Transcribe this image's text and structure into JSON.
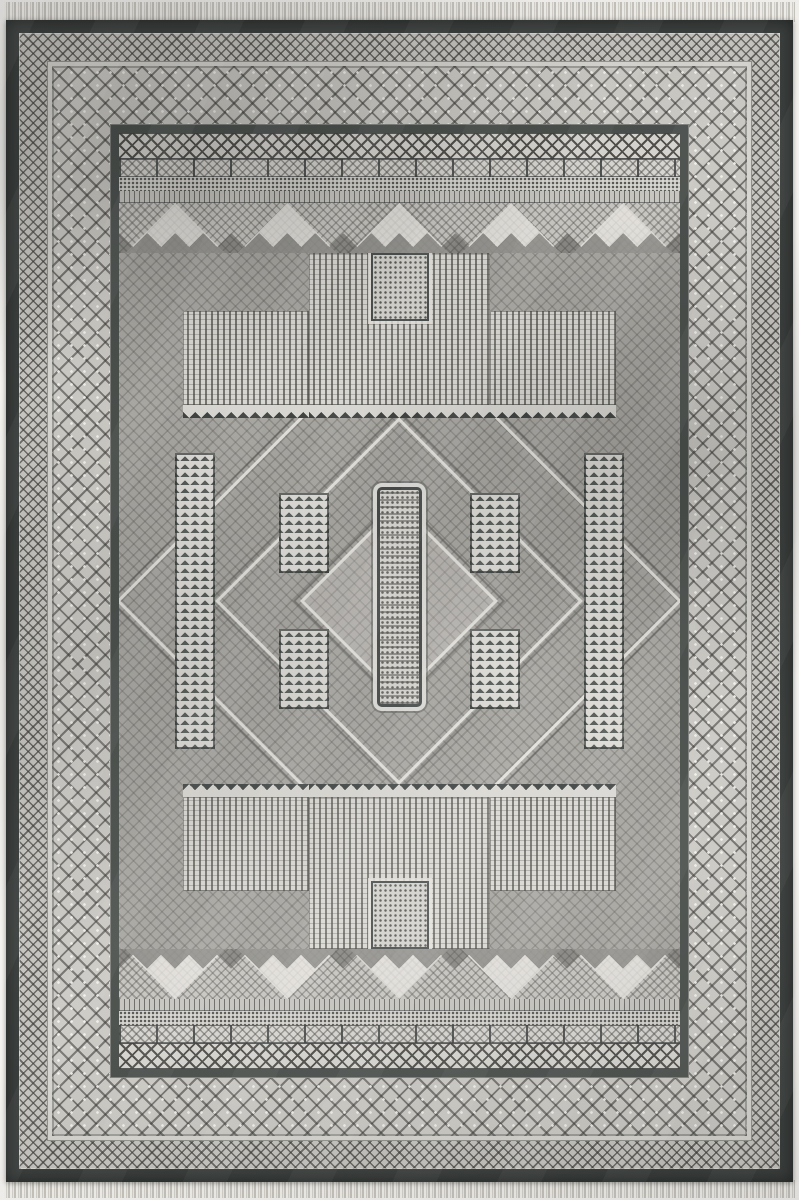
{
  "image": {
    "type": "photograph",
    "subject": "Gray traditional geometric area rug, portrait orientation, with white knotted fringe along the top and bottom edges",
    "style": "monochrome gray tribal/geometric pattern with nested borders and a symmetric central medallion composition"
  },
  "palette": {
    "bg": "#f6f4f1",
    "fringe": "#efede8",
    "frame": "#3c403e",
    "guard": "#4a4f4c",
    "band-light": "#c6c4bf",
    "pat-light": "#d6d4cf",
    "pat-dark": "#504f4b",
    "field": "#a7a5a0",
    "stripe-light": "#d9d7d2",
    "picket-dark": "#3f4442"
  },
  "rug": {
    "parts": [
      {
        "name": "fringe-top"
      },
      {
        "name": "outer-charcoal-frame"
      },
      {
        "name": "minor-diamond-border"
      },
      {
        "name": "major-diamond-border"
      },
      {
        "name": "dark-guard-stripe"
      },
      {
        "name": "zigzag-band"
      },
      {
        "name": "tile-band"
      },
      {
        "name": "dot-band"
      },
      {
        "name": "pyramid-band"
      },
      {
        "name": "central-field"
      },
      {
        "name": "concentric-diamond-medallions"
      },
      {
        "name": "striped-curtain-panels-with-picket-points"
      },
      {
        "name": "tassel-columns"
      },
      {
        "name": "central-ornamental-column"
      },
      {
        "name": "fringe-bottom"
      }
    ]
  }
}
